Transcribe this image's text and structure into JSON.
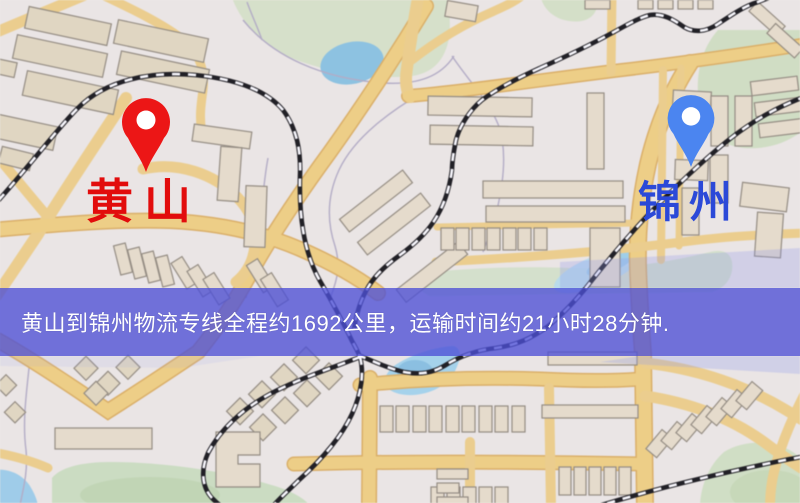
{
  "map": {
    "origin": {
      "label": "黄山"
    },
    "destination": {
      "label": "锦州"
    },
    "banner": {
      "text": "黄山到锦州物流专线全程约1692公里，运输时间约21小时28分钟."
    },
    "route": {
      "distance_km": "1692",
      "duration": "21小时28分钟"
    }
  },
  "colors": {
    "origin_pin": "#ec1616",
    "origin_label": "#e20c0c",
    "destination_pin": "#4b85f0",
    "destination_label": "#2b49d8",
    "banner_bg": "rgba(77,80,214,0.78)",
    "banner_text": "#ffffff"
  }
}
